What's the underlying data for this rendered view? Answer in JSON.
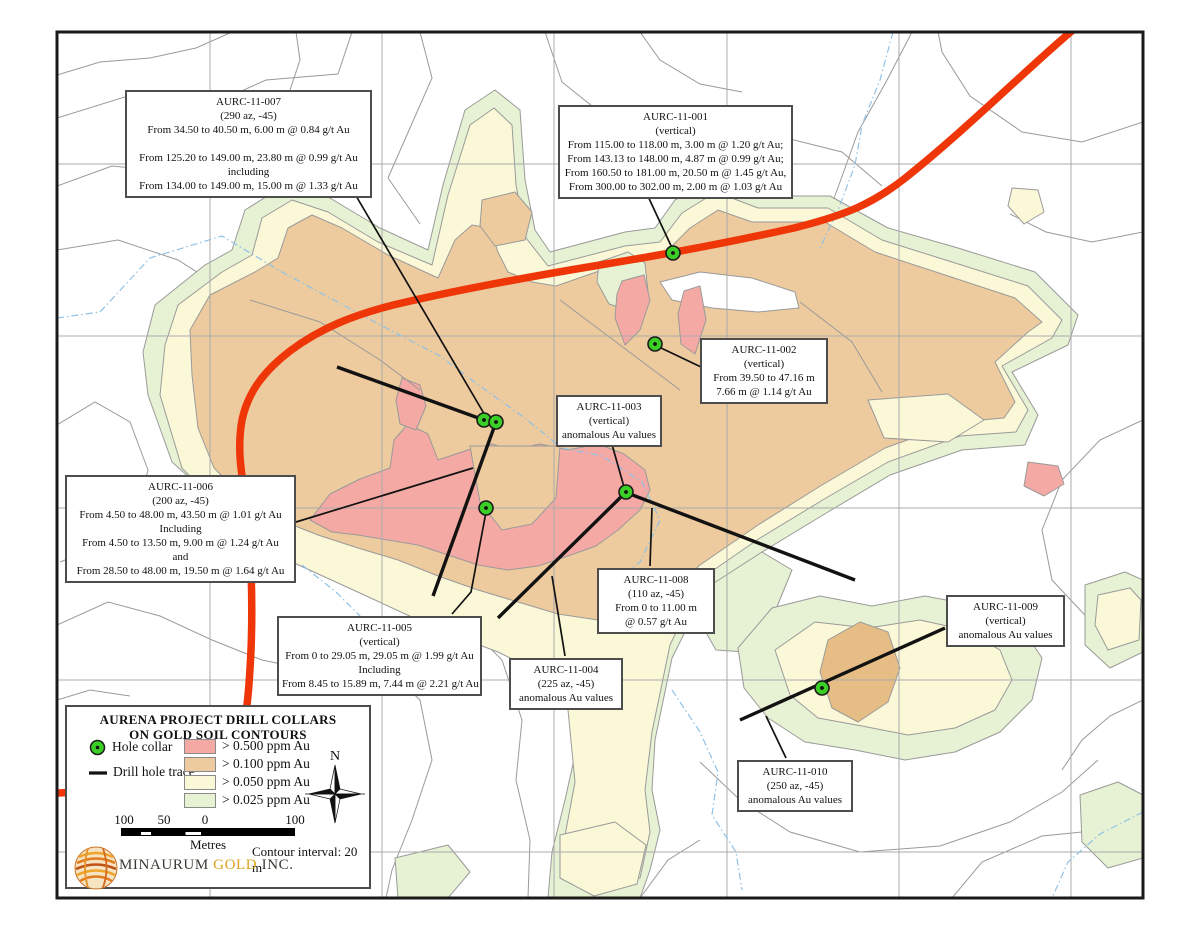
{
  "legend": {
    "title_line1": "AURENA PROJECT DRILL COLLARS",
    "title_line2": "ON GOLD SOIL CONTOURS",
    "hole_collar_label": "Hole collar",
    "drill_trace_label": "Drill hole trace",
    "swatches": [
      {
        "label": "> 0.500 ppm Au",
        "color": "#F5A9A4"
      },
      {
        "label": "> 0.100 ppm Au",
        "color": "#EDCB9E"
      },
      {
        "label": "> 0.050 ppm Au",
        "color": "#FBF8D8"
      },
      {
        "label": "> 0.025 ppm Au",
        "color": "#E6F2D3"
      }
    ],
    "compass_label": "N",
    "scale_labels": [
      "100",
      "50",
      "0",
      "100"
    ],
    "scale_unit": "Metres",
    "contour_interval": "Contour interval: 20 m",
    "company_name_1": "MINAURUM",
    "company_name_2": "GOLD",
    "company_name_3": "INC."
  },
  "annotations": [
    {
      "id": "AURC-11-007",
      "lines": [
        "AURC-11-007",
        "(290 az, -45)",
        "From 34.50 to 40.50 m, 6.00 m @ 0.84 g/t Au",
        "",
        "From 125.20 to 149.00 m, 23.80 m @ 0.99 g/t Au",
        "including",
        "From 134.00 to 149.00 m, 15.00 m @ 1.33 g/t Au"
      ]
    },
    {
      "id": "AURC-11-001",
      "lines": [
        "AURC-11-001",
        "(vertical)",
        "From 115.00 to 118.00 m, 3.00 m @ 1.20 g/t Au;",
        "From 143.13 to 148.00 m, 4.87 m @ 0.99 g/t Au;",
        "From 160.50 to 181.00 m, 20.50 m @ 1.45 g/t Au,",
        "From 300.00 to 302.00 m, 2.00 m @ 1.03 g/t Au"
      ]
    },
    {
      "id": "AURC-11-002",
      "lines": [
        "AURC-11-002",
        "(vertical)",
        "From 39.50 to 47.16 m",
        "7.66 m @ 1.14 g/t Au"
      ]
    },
    {
      "id": "AURC-11-003",
      "lines": [
        "AURC-11-003",
        "(vertical)",
        "anomalous Au values"
      ]
    },
    {
      "id": "AURC-11-006",
      "lines": [
        "AURC-11-006",
        "(200 az, -45)",
        "From 4.50 to 48.00 m, 43.50 m @ 1.01 g/t Au",
        "Including",
        "From 4.50 to 13.50 m, 9.00 m @ 1.24 g/t Au",
        "and",
        "From 28.50 to 48.00 m, 19.50 m @ 1.64 g/t Au"
      ]
    },
    {
      "id": "AURC-11-005",
      "lines": [
        "AURC-11-005",
        "(vertical)",
        "From 0 to 29.05 m, 29.05 m @ 1.99 g/t Au",
        "Including",
        "From 8.45 to 15.89 m, 7.44 m @ 2.21 g/t Au"
      ]
    },
    {
      "id": "AURC-11-008",
      "lines": [
        "AURC-11-008",
        "(110 az, -45)",
        "From 0 to 11.00 m",
        "@ 0.57 g/t Au"
      ]
    },
    {
      "id": "AURC-11-004",
      "lines": [
        "AURC-11-004",
        "(225 az, -45)",
        "anomalous Au values"
      ]
    },
    {
      "id": "AURC-11-009",
      "lines": [
        "AURC-11-009",
        "(vertical)",
        "anomalous Au values"
      ]
    },
    {
      "id": "AURC-11-010",
      "lines": [
        "AURC-11-010",
        "(250 az, -45)",
        "anomalous Au values"
      ]
    }
  ],
  "map": {
    "colors": {
      "road": "#EE3608",
      "collar": "#3BCE27",
      "pink": "#F5A9A4",
      "tan": "#EDCB9E",
      "orange_core": "#E5BD85",
      "yellow": "#FBF8D8",
      "green": "#E6F2D3",
      "contour_line": "#9A9A9A",
      "grid_line": "#ABABAB",
      "stream": "#90C2E6"
    }
  }
}
